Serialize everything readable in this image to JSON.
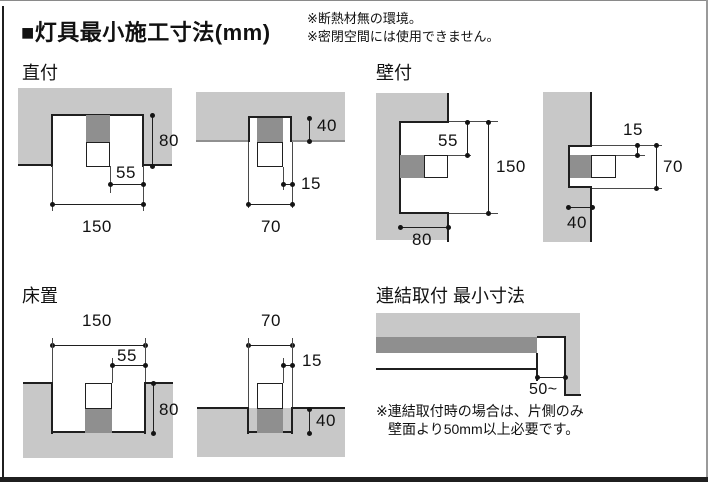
{
  "header": {
    "title": "■灯具最小施工寸法(mm)",
    "notes": [
      "※断熱材無の環境。",
      "※密閉空間には使用できません。"
    ]
  },
  "sections": {
    "direct_mount": {
      "label": "直付",
      "wide": {
        "width": "150",
        "offset": "55",
        "depth": "80"
      },
      "narrow": {
        "width": "70",
        "offset": "15",
        "depth": "40"
      }
    },
    "wall_mount": {
      "label": "壁付",
      "wide": {
        "height": "150",
        "offset": "55",
        "depth": "80"
      },
      "narrow": {
        "height": "70",
        "offset": "15",
        "depth": "40"
      }
    },
    "floor_mount": {
      "label": "床置",
      "wide": {
        "width": "150",
        "offset": "55",
        "depth": "80"
      },
      "narrow": {
        "width": "70",
        "offset": "15",
        "depth": "40"
      }
    },
    "linked_mount": {
      "label": "連結取付 最小寸法",
      "clearance": "50~",
      "notes": [
        "※連結取付時の場合は、片側のみ",
        "壁面より50mm以上必要です。"
      ]
    }
  },
  "colors": {
    "structure_gray": "#c8c8c8",
    "fixture_gray": "#8f8f8f"
  }
}
